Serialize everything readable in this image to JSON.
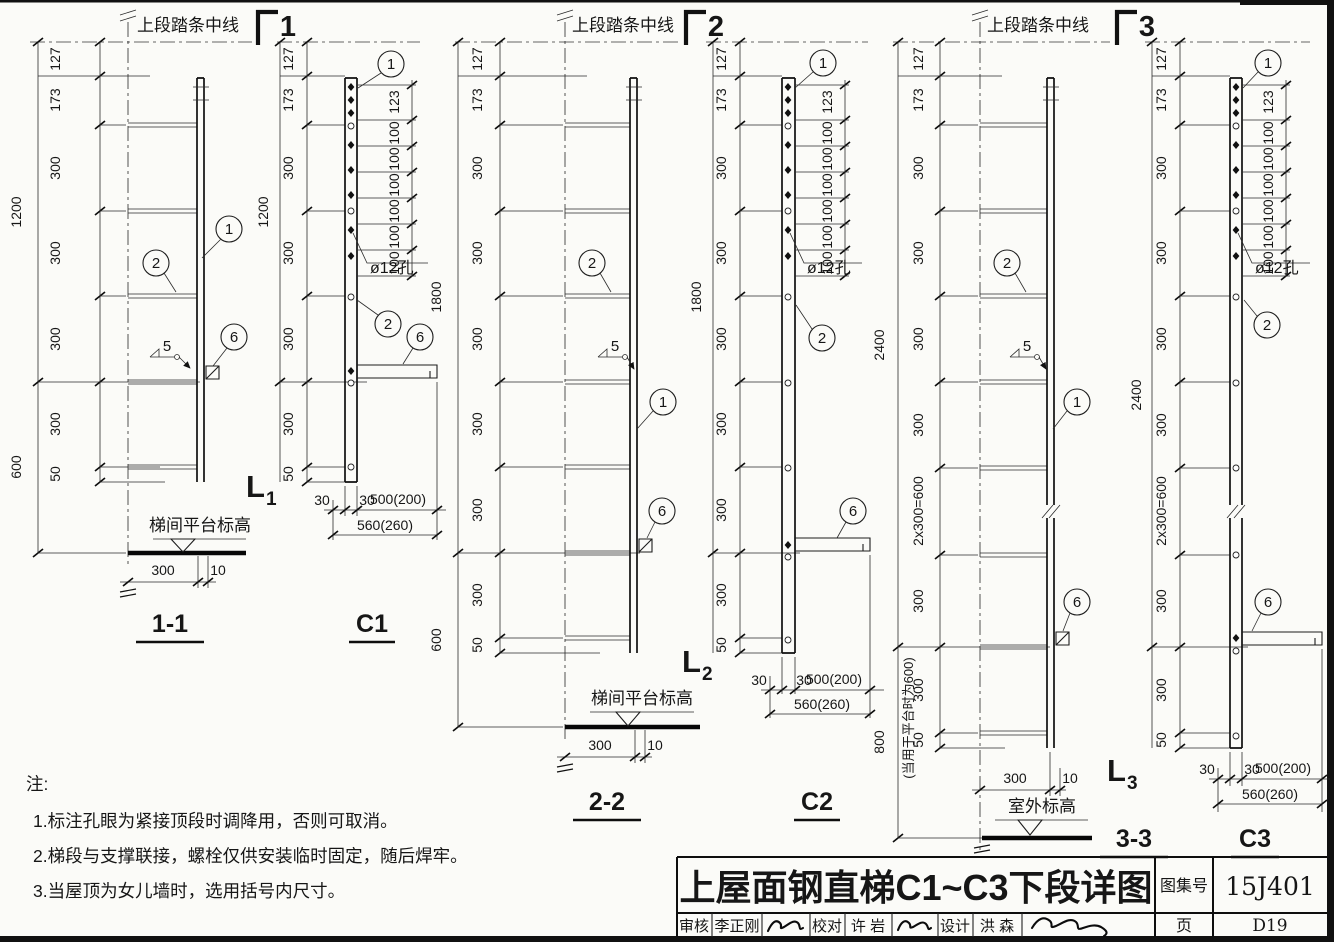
{
  "views": {
    "s11": {
      "top_label": "上段踏条中线",
      "section_no": "1",
      "outer_dims": [
        "1200",
        "600"
      ],
      "inner_dims": [
        "127",
        "173",
        "300",
        "300",
        "300",
        "300",
        "50"
      ],
      "callout_1": "1",
      "callout_2": "2",
      "callout_6": "6",
      "weld_no": "5",
      "ladder_mark": "L",
      "ladder_sub": "1",
      "platform_label": "梯间平台标高",
      "dim_300": "300",
      "dim_10": "10",
      "title": "1-1"
    },
    "c1": {
      "outer_dims": [
        "1200"
      ],
      "inner_dims": [
        "127",
        "173",
        "300",
        "300",
        "300",
        "300",
        "50"
      ],
      "hole_dims": [
        "123",
        "100",
        "100",
        "100",
        "100",
        "100",
        "100"
      ],
      "hole_label": "ø12孔",
      "callout_1": "1",
      "callout_2": "2",
      "callout_6": "6",
      "bottom_dims": [
        "30",
        "30",
        "500(200)",
        "560(260)"
      ],
      "title": "C1"
    },
    "s22": {
      "top_label": "上段踏条中线",
      "section_no": "2",
      "outer_dims": [
        "1800",
        "600"
      ],
      "inner_dims": [
        "127",
        "173",
        "300",
        "300",
        "300",
        "300",
        "300",
        "300",
        "50"
      ],
      "callout_1": "1",
      "callout_2": "2",
      "callout_6": "6",
      "weld_no": "5",
      "ladder_mark": "L",
      "ladder_sub": "2",
      "platform_label": "梯间平台标高",
      "dim_300": "300",
      "dim_10": "10",
      "title": "2-2"
    },
    "c2": {
      "outer_dims": [
        "1800"
      ],
      "inner_dims": [
        "127",
        "173",
        "300",
        "300",
        "300",
        "300",
        "300",
        "300",
        "50"
      ],
      "hole_dims": [
        "123",
        "100",
        "100",
        "100",
        "100",
        "100",
        "100"
      ],
      "hole_label": "ø12孔",
      "callout_1": "1",
      "callout_2": "2",
      "callout_6": "6",
      "bottom_dims": [
        "30",
        "30",
        "500(200)",
        "560(260)"
      ],
      "title": "C2"
    },
    "s33": {
      "top_label": "上段踏条中线",
      "section_no": "3",
      "outer_dims": [
        "2400",
        "800"
      ],
      "outer_note": "(当用于平台时为600)",
      "inner_dims": [
        "127",
        "173",
        "300",
        "300",
        "300",
        "300",
        "2x300=600",
        "300",
        "300",
        "50"
      ],
      "callout_1": "1",
      "callout_2": "2",
      "callout_6": "6",
      "weld_no": "5",
      "ladder_mark": "L",
      "ladder_sub": "3",
      "platform_label": "室外标高",
      "dim_300": "300",
      "dim_10": "10",
      "title": "3-3"
    },
    "c3": {
      "outer_dims": [
        "2400"
      ],
      "inner_dims": [
        "127",
        "173",
        "300",
        "300",
        "300",
        "300",
        "2x300=600",
        "300",
        "300",
        "50"
      ],
      "hole_dims": [
        "123",
        "100",
        "100",
        "100",
        "100",
        "100",
        "100"
      ],
      "hole_label": "ø12孔",
      "callout_1": "1",
      "callout_2": "2",
      "callout_6": "6",
      "bottom_dims": [
        "30",
        "30",
        "500(200)",
        "560(260)"
      ],
      "title": "C3"
    }
  },
  "notes": {
    "heading": "注:",
    "items": [
      "1.标注孔眼为紧接顶段时调降用，否则可取消。",
      "2.梯段与支撑联接，螺栓仅供安装临时固定，随后焊牢。",
      "3.当屋顶为女儿墙时，选用括号内尺寸。"
    ]
  },
  "title_block": {
    "title": "上屋面钢直梯C1~C3下段详图",
    "atlas_label": "图集号",
    "atlas_no": "15J401",
    "page_label": "页",
    "page_no": "D19",
    "audit_label": "审核",
    "auditor": "李正刚",
    "check_label": "校对",
    "checker": "许 岩",
    "design_label": "设计",
    "designer": "洪 森"
  }
}
